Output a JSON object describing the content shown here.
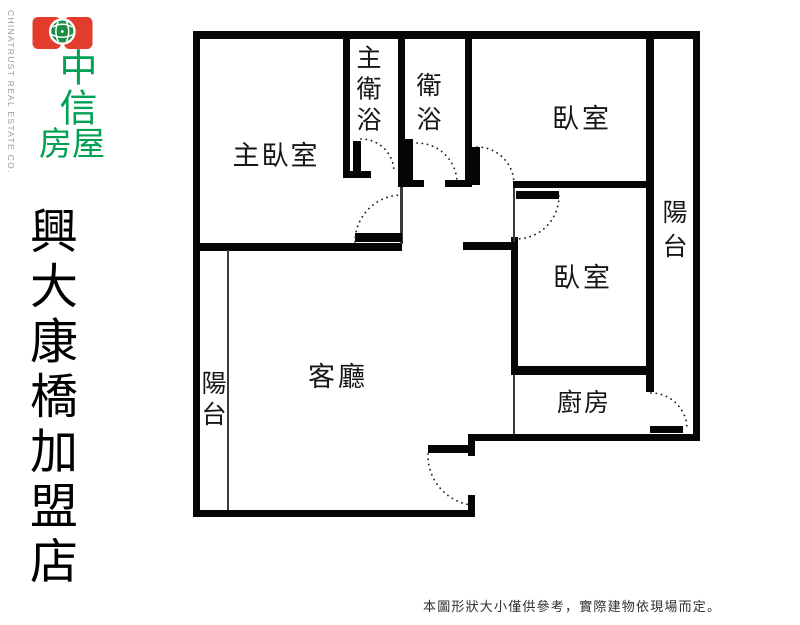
{
  "logo": {
    "company_cn_top": "中信",
    "company_cn_bottom": "房屋",
    "company_en": "CHINATRUST REAL ESTATE CO.",
    "red": "#e23c2c",
    "green": "#00a152"
  },
  "branch": {
    "name_vertical": "興大康橋加盟店"
  },
  "floorplan": {
    "rooms": [
      {
        "id": "master-bedroom",
        "label": "主臥室",
        "orientation": "horizontal"
      },
      {
        "id": "master-bathroom",
        "label": "主衛浴",
        "orientation": "vertical"
      },
      {
        "id": "bathroom",
        "label": "衛浴",
        "orientation": "vertical"
      },
      {
        "id": "bedroom-top",
        "label": "臥室",
        "orientation": "horizontal"
      },
      {
        "id": "balcony-right",
        "label": "陽台",
        "orientation": "vertical"
      },
      {
        "id": "bedroom-middle",
        "label": "臥室",
        "orientation": "horizontal"
      },
      {
        "id": "kitchen",
        "label": "廚房",
        "orientation": "horizontal"
      },
      {
        "id": "living-room",
        "label": "客廳",
        "orientation": "horizontal"
      },
      {
        "id": "balcony-left",
        "label": "陽台",
        "orientation": "vertical"
      }
    ]
  },
  "disclaimer": "本圖形狀大小僅供參考，實際建物依現場而定。"
}
